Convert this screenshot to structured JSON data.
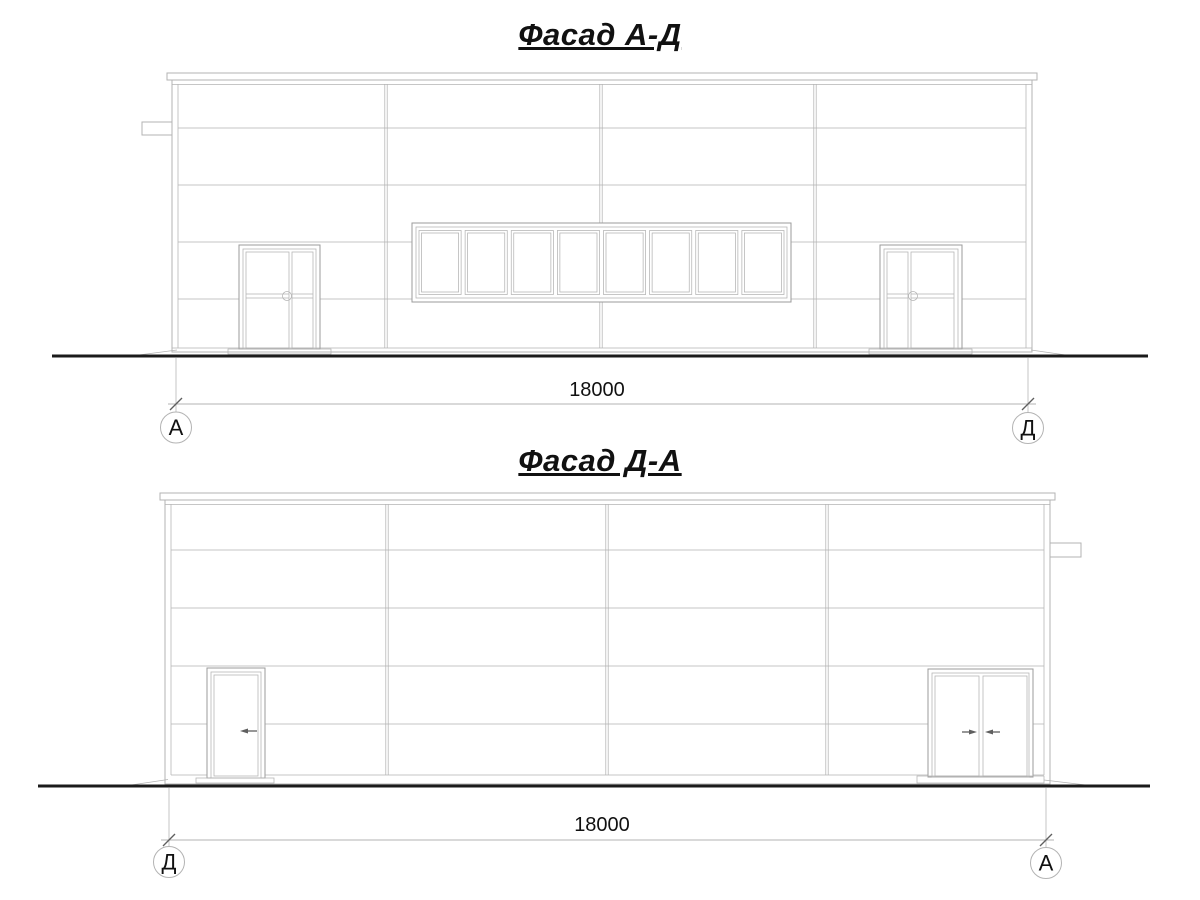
{
  "colors": {
    "background": "#ffffff",
    "line": "#b3b3b3",
    "line_dark": "#9b9b9b",
    "ground": "#1b1b1b",
    "tick": "#5f5f5f",
    "ink": "#111111"
  },
  "facades": [
    {
      "title": "Фасад А-Д",
      "dimension_value": "18000",
      "axis_left": "А",
      "axis_right": "Д",
      "window_panes": 8
    },
    {
      "title": "Фасад Д-А",
      "dimension_value": "18000",
      "axis_left": "Д",
      "axis_right": "А"
    }
  ]
}
